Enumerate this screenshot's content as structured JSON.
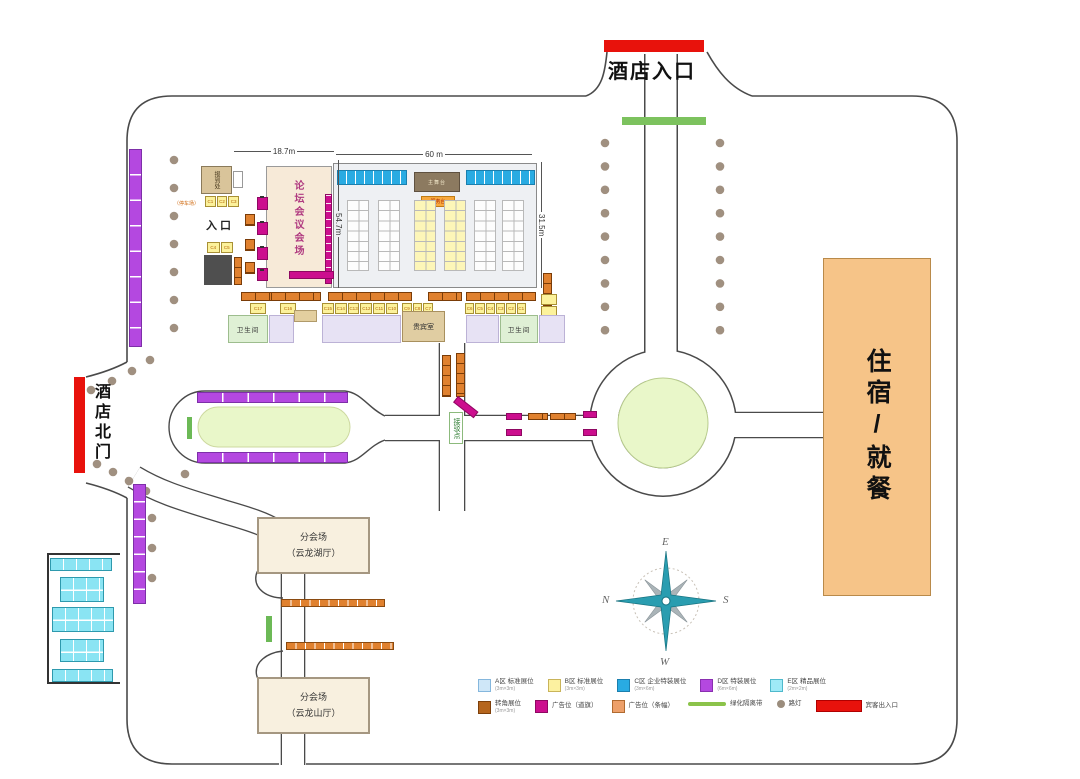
{
  "gates": {
    "main_entrance": "酒店入口",
    "north_gate": "酒店北门"
  },
  "buildings": {
    "lodging": "住宿/就餐",
    "forum_hall": "论坛会议会场",
    "registration": "报到处",
    "vip_room": "贵宾室",
    "toilet_left": "卫生间",
    "toilet_right": "卫生间",
    "stage": "主舞台",
    "service_desk": "服务台",
    "sub_venue_lake_line1": "分会场",
    "sub_venue_lake_line2": "（云龙湖厅）",
    "sub_venue_mountain_line1": "分会场",
    "sub_venue_mountain_line2": "（云龙山厅）"
  },
  "labels": {
    "entrance_small": "入口",
    "shuttle_point": "接驳点",
    "parking": "（停车场）"
  },
  "dimensions": {
    "forum_width": "18.7m",
    "main_width": "60 m",
    "forum_depth": "54.7m",
    "main_depth": "31.5m"
  },
  "compass": {
    "top": "E",
    "left": "N",
    "right": "S",
    "bottom": "W"
  },
  "booths": {
    "c_row": [
      [
        "C17",
        "C16"
      ],
      [
        "C15",
        "C14",
        "C13",
        "C12",
        "C11",
        "C10"
      ],
      [
        "C9",
        "C8",
        "C7"
      ],
      [
        "C6",
        "C5",
        "C4",
        "C3",
        "C2",
        "C1"
      ]
    ],
    "reg_strip": [
      "C1",
      "C2",
      "C3"
    ],
    "reg_box": [
      "C4",
      "C5"
    ]
  },
  "legend": {
    "row1": [
      {
        "shape": "rect",
        "color": "#cfe7f8",
        "border": "#85b7dd",
        "label": "A区 标准展位",
        "sub": "(3m×3m)"
      },
      {
        "shape": "rect",
        "color": "#fcf1a0",
        "border": "#c9b45a",
        "label": "B区 标准展位",
        "sub": "(3m×3m)"
      },
      {
        "shape": "rect",
        "color": "#29abe2",
        "border": "#1b7fae",
        "label": "C区 企业特装展位",
        "sub": "(3m×6m)"
      },
      {
        "shape": "rect",
        "color": "#b448e0",
        "border": "#8a2fb0",
        "label": "D区 特装展位",
        "sub": "(6m×6m)"
      },
      {
        "shape": "rect",
        "color": "#9feaf7",
        "border": "#4fb9cc",
        "label": "E区 精品展位",
        "sub": "(2m×2m)"
      }
    ],
    "row2": [
      {
        "shape": "rect",
        "color": "#b5651d",
        "border": "#7d3f0a",
        "label": "转角展位",
        "sub": "(3m×3m)"
      },
      {
        "shape": "rect",
        "color": "#cc0e8e",
        "border": "#8e0862",
        "label": "广告位（道旗）",
        "sub": ""
      },
      {
        "shape": "rect",
        "color": "#eda06a",
        "border": "#b06a30",
        "label": "广告位（条幅）",
        "sub": ""
      },
      {
        "shape": "line",
        "color": "#8bc34a",
        "border": "",
        "label": "绿化隔离带",
        "sub": ""
      },
      {
        "shape": "dot",
        "color": "#9b8d7d",
        "border": "",
        "label": "路灯",
        "sub": ""
      },
      {
        "shape": "bar",
        "color": "#e8120c",
        "border": "#b00000",
        "label": "宾客出入口",
        "sub": ""
      }
    ]
  },
  "colors": {
    "road": "#4a4a4a",
    "accent_red": "#e8120c",
    "lawn": "#e9f7c9",
    "lodging_fill": "#f6c488"
  }
}
